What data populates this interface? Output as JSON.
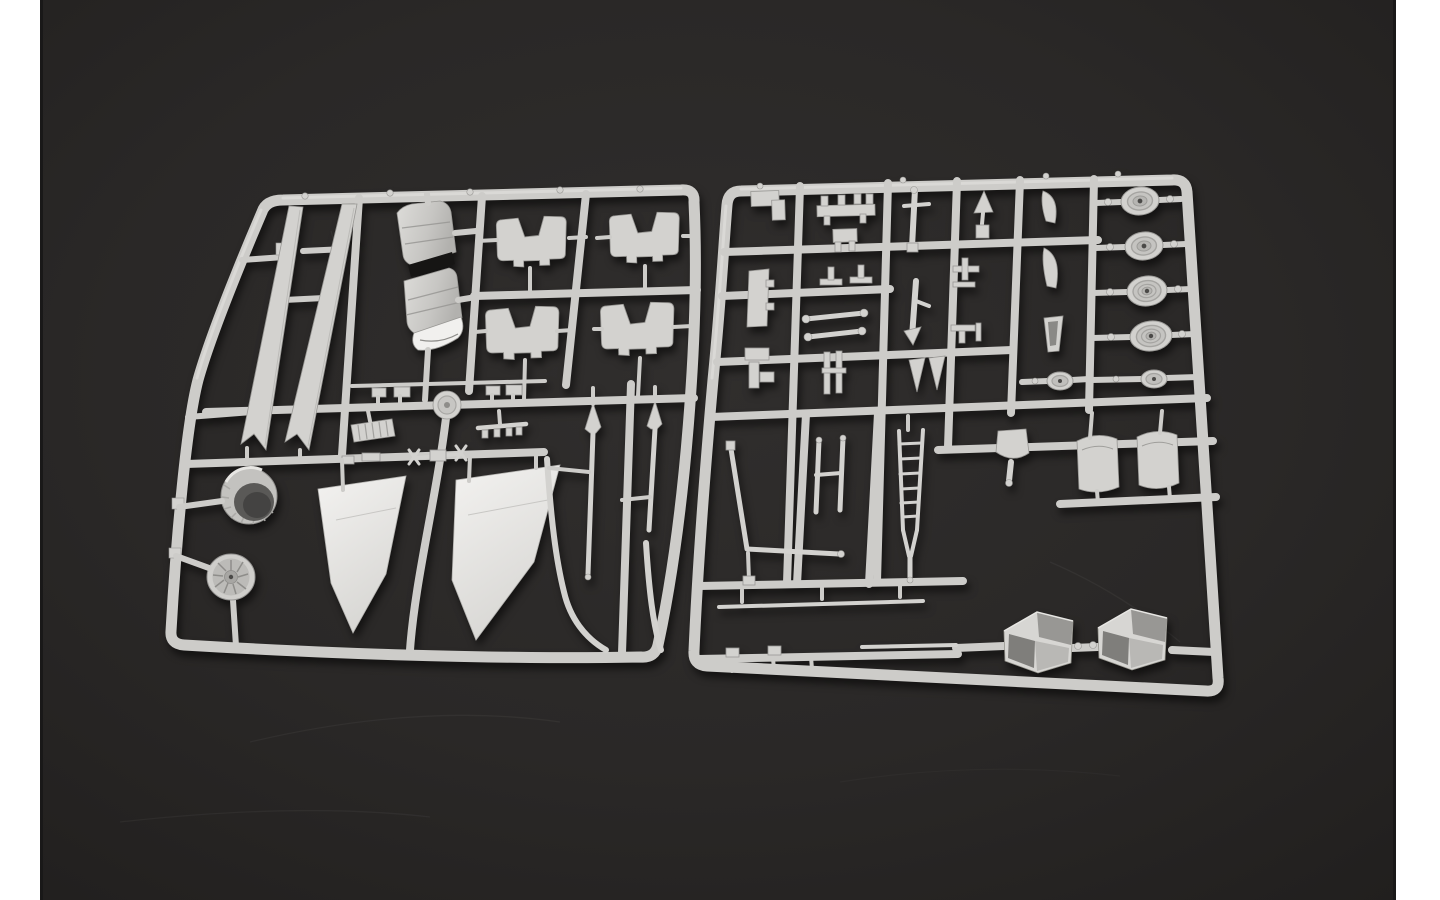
{
  "scene": {
    "type": "photograph",
    "subject": "Two light-gray injection-molded plastic model-kit sprues (part runners) of an aircraft model kit lying side by side on a dark charcoal surface, framed by white vertical bars at the left and right edges",
    "background": "dark charcoal studio surface with faint scratches",
    "side_bars": "white vertical bars"
  },
  "colors": {
    "bg_center": "#302e2d",
    "bg_mid": "#2a2827",
    "bg_edge": "#211f1e",
    "side_bar": "#ffffff",
    "plastic": "#cdccc9",
    "plastic_hi": "#e7e6e3",
    "plastic_part": "#d3d2cf",
    "plastic_bright": "#f1f0ee",
    "plastic_mid": "#b9b8b5",
    "plastic_edge": "#989794",
    "plastic_dark": "#8a8986",
    "cavity_dark": "#5a5957",
    "gap_black": "#161514",
    "hub_dot": "#4b4a48"
  },
  "sprues": {
    "left": {
      "name": "left-sprue",
      "parts": [
        {
          "name": "tail-fin-blade",
          "count": 2
        },
        {
          "name": "engine-nacelle-can",
          "count": 2
        },
        {
          "name": "intake-ramp",
          "count": 4
        },
        {
          "name": "engine-nozzle-ring",
          "count": 1
        },
        {
          "name": "turbine-fan-disc",
          "count": 1
        },
        {
          "name": "wing-panel",
          "count": 2
        },
        {
          "name": "pointed-pitot-rod",
          "count": 2
        },
        {
          "name": "curved-antenna-boom",
          "count": 2
        },
        {
          "name": "rail-boss-disc",
          "count": 1
        },
        {
          "name": "ribbed-grille-plate",
          "count": 1
        },
        {
          "name": "small-detail-part",
          "count": 8
        }
      ]
    },
    "right": {
      "name": "right-sprue",
      "parts": [
        {
          "name": "road-wheel-large",
          "count": 4
        },
        {
          "name": "road-wheel-small",
          "count": 2
        },
        {
          "name": "boarding-ladder",
          "count": 1
        },
        {
          "name": "twin-rod-linkage",
          "count": 1
        },
        {
          "name": "l-profile-rail",
          "count": 1
        },
        {
          "name": "funnel-intake",
          "count": 1
        },
        {
          "name": "saddle-panel",
          "count": 2
        },
        {
          "name": "intake-trunk-box",
          "count": 2
        },
        {
          "name": "long-thin-strip",
          "count": 1
        },
        {
          "name": "landing-gear-strut",
          "count": 2
        },
        {
          "name": "small-bracket-part",
          "count": 18
        }
      ]
    }
  }
}
